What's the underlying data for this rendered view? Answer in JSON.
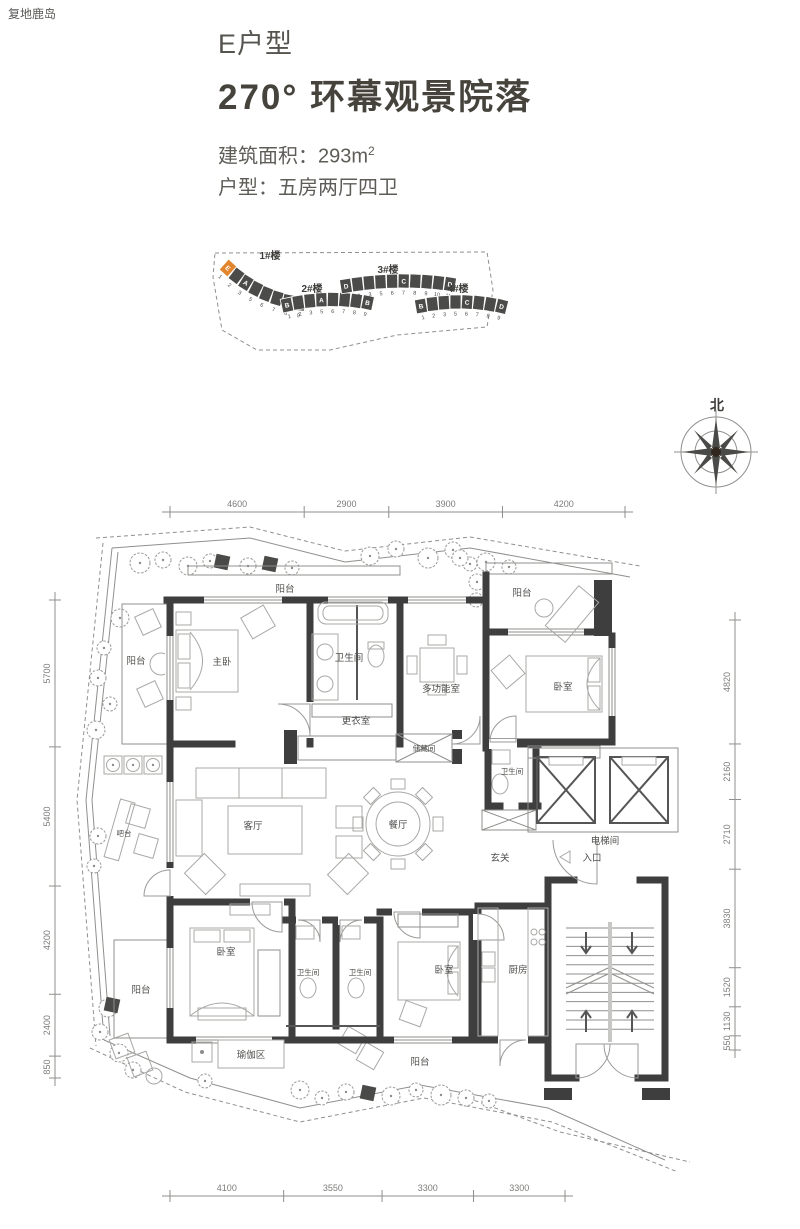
{
  "brand": "复地鹿岛",
  "header": {
    "unit_type": "E户型",
    "title": "270° 环幕观景院落",
    "area_label": "建筑面积：",
    "area_value": "293m",
    "area_sup": "2",
    "layout_label": "户型：",
    "layout_value": "五房两厅四卫"
  },
  "siteplan": {
    "highlight_color": "#e2862e",
    "buildings": [
      {
        "name": "1#楼",
        "cells": [
          "E",
          "",
          "A",
          "",
          "",
          "",
          "",
          "B"
        ],
        "numbers": [
          "1",
          "2",
          "3",
          "5",
          "6",
          "7",
          "8",
          "9"
        ],
        "highlight_index": 0
      },
      {
        "name": "2#楼",
        "cells": [
          "B",
          "",
          "",
          "A",
          "",
          "",
          "",
          "B"
        ],
        "numbers": [
          "1",
          "2",
          "3",
          "5",
          "6",
          "7",
          "8",
          "9"
        ],
        "highlight_index": -1
      },
      {
        "name": "3#楼",
        "cells": [
          "D",
          "",
          "",
          "",
          "",
          "C",
          "",
          "",
          "",
          "D"
        ],
        "numbers": [
          "1",
          "2",
          "3",
          "5",
          "6",
          "7",
          "8",
          "9",
          "10",
          "11"
        ],
        "highlight_index": -1
      },
      {
        "name": "4#楼",
        "cells": [
          "B",
          "",
          "",
          "",
          "C",
          "",
          "",
          "D"
        ],
        "numbers": [
          "1",
          "2",
          "3",
          "5",
          "6",
          "7",
          "8",
          "9"
        ],
        "highlight_index": -1
      }
    ]
  },
  "compass": {
    "north": "北"
  },
  "plan": {
    "rooms": [
      {
        "id": "balcony-top",
        "label": "阳台"
      },
      {
        "id": "master-bedroom",
        "label": "主卧"
      },
      {
        "id": "bath-top",
        "label": "卫生间"
      },
      {
        "id": "multi-room",
        "label": "多功能室"
      },
      {
        "id": "balcony-top-right",
        "label": "阳台"
      },
      {
        "id": "bedroom-top-right",
        "label": "卧室"
      },
      {
        "id": "dressing-room",
        "label": "更衣室"
      },
      {
        "id": "storage-room",
        "label": "储藏间"
      },
      {
        "id": "balcony-left",
        "label": "阳台"
      },
      {
        "id": "bar-counter",
        "label": "吧台"
      },
      {
        "id": "living-room",
        "label": "客厅"
      },
      {
        "id": "dining-room",
        "label": "餐厅"
      },
      {
        "id": "bath-mid",
        "label": "卫生间"
      },
      {
        "id": "elevator-hall",
        "label": "电梯间"
      },
      {
        "id": "foyer",
        "label": "玄关"
      },
      {
        "id": "entrance",
        "label": "入口"
      },
      {
        "id": "bedroom-bottom-left",
        "label": "卧室"
      },
      {
        "id": "bath-b1",
        "label": "卫生间"
      },
      {
        "id": "bath-b2",
        "label": "卫生间"
      },
      {
        "id": "bedroom-bottom-mid",
        "label": "卧室"
      },
      {
        "id": "kitchen",
        "label": "厨房"
      },
      {
        "id": "balcony-bottom-left",
        "label": "阳台"
      },
      {
        "id": "yoga-area",
        "label": "瑜伽区"
      },
      {
        "id": "balcony-bottom",
        "label": "阳台"
      }
    ],
    "dims": {
      "top": [
        "4600",
        "2900",
        "3900",
        "4200"
      ],
      "left": [
        "5700",
        "5400",
        "4200",
        "2400",
        "850"
      ],
      "right": [
        "4820",
        "2160",
        "2710",
        "3830",
        "1520",
        "1130",
        "550"
      ],
      "bottom": [
        "4100",
        "3550",
        "3300",
        "3300"
      ]
    }
  }
}
